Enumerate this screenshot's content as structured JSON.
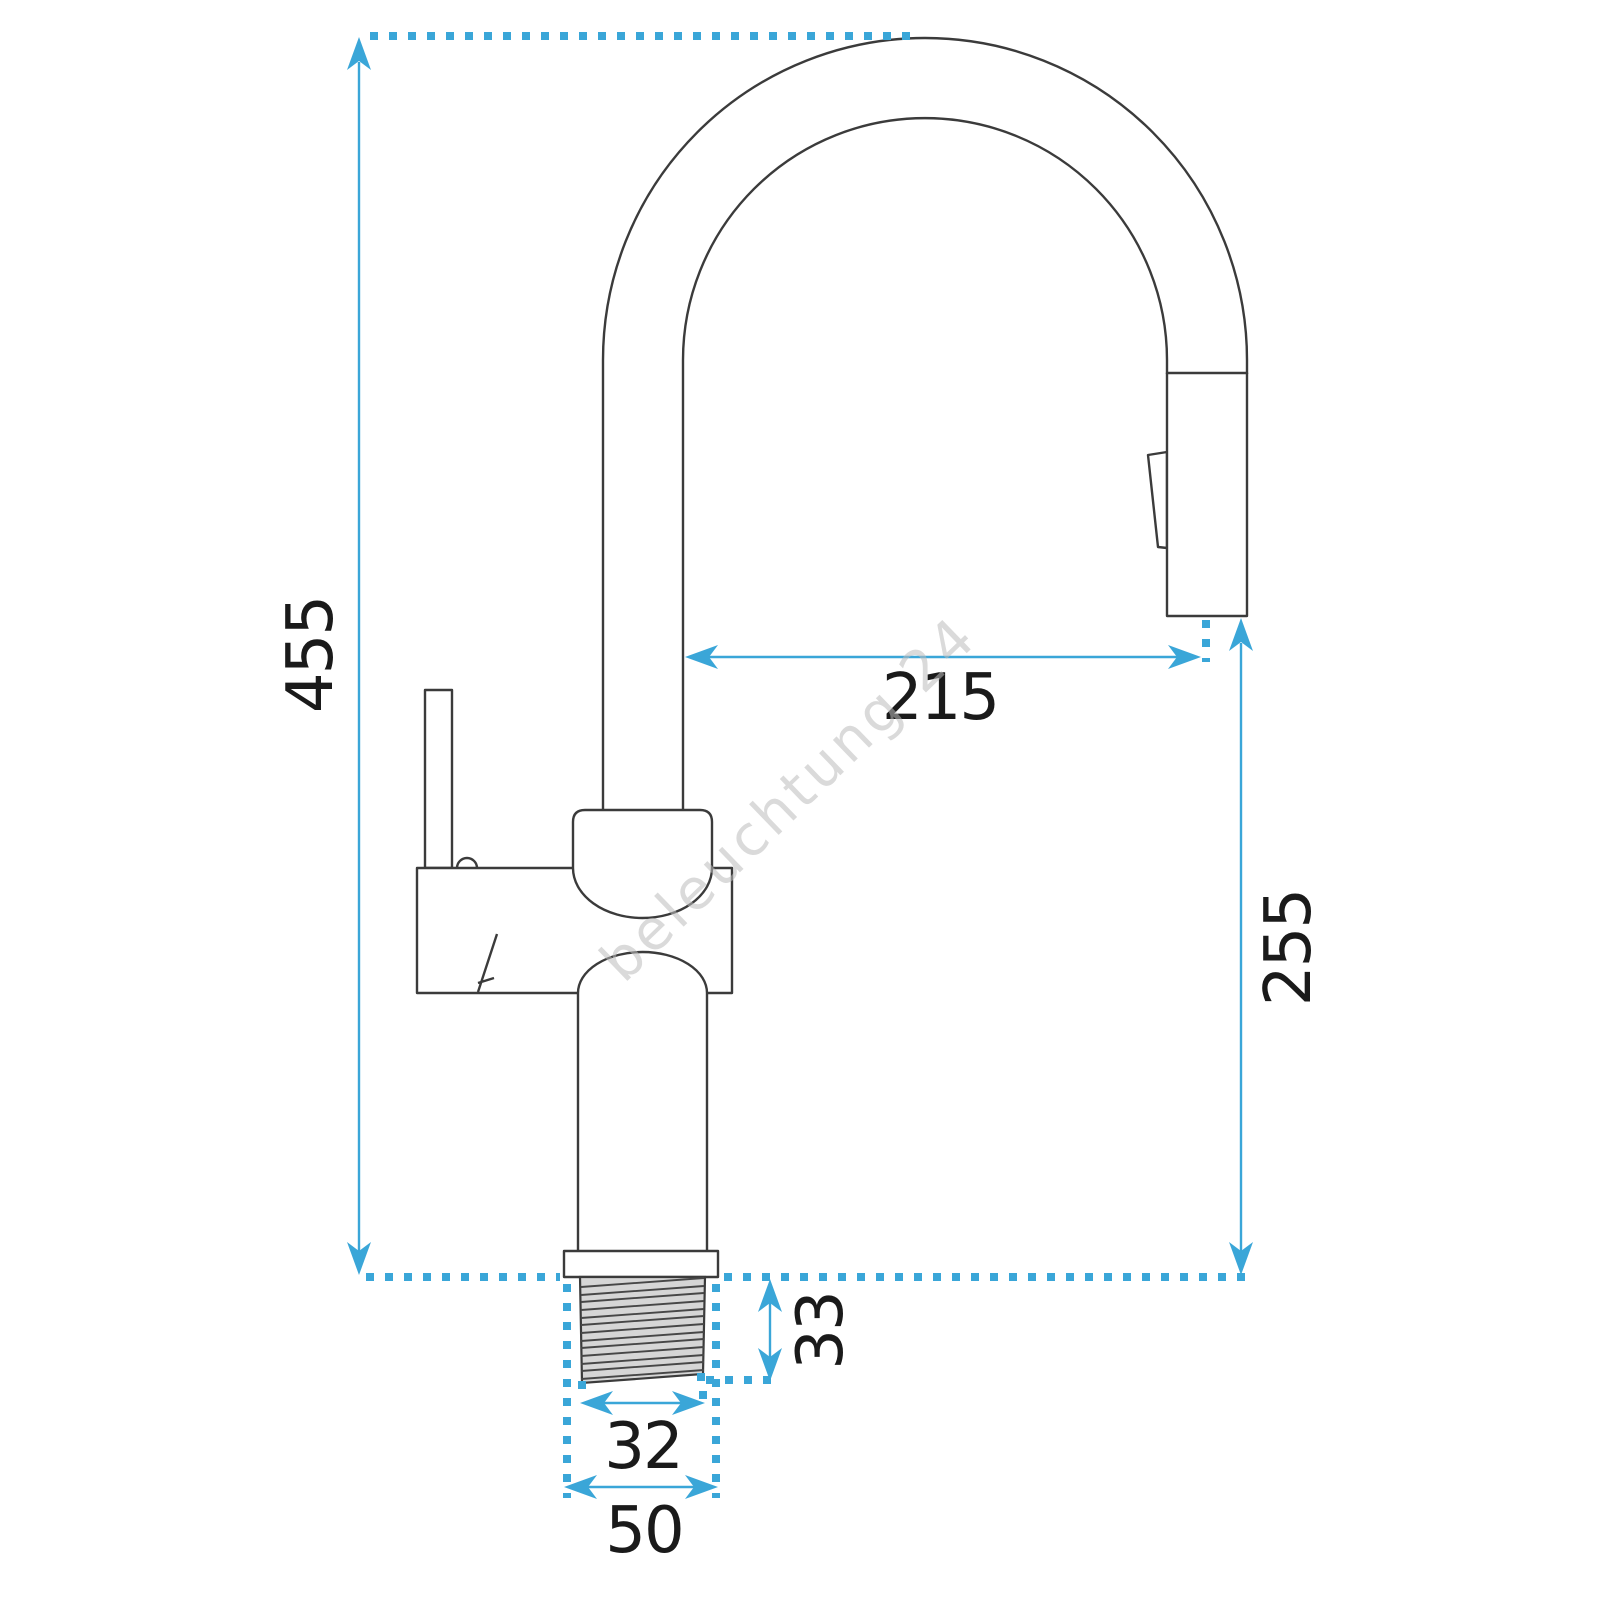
{
  "drawing": {
    "title": "faucet-dimension-diagram",
    "subject": "kitchen faucet with pull-out spout, side elevation",
    "dimensions": {
      "total_height": "455",
      "spout_reach": "215",
      "outlet_height": "255",
      "thread_length": "33",
      "thread_diameter": "32",
      "base_diameter": "50"
    }
  },
  "watermark": {
    "text": "beleuchtung 24"
  },
  "colors": {
    "dimension_blue": "#3AA6D8",
    "outline_dark": "#3B3B3B",
    "thread_fill": "#D6D6D6",
    "label_text": "#1A1A1A",
    "background": "#FFFFFF"
  }
}
